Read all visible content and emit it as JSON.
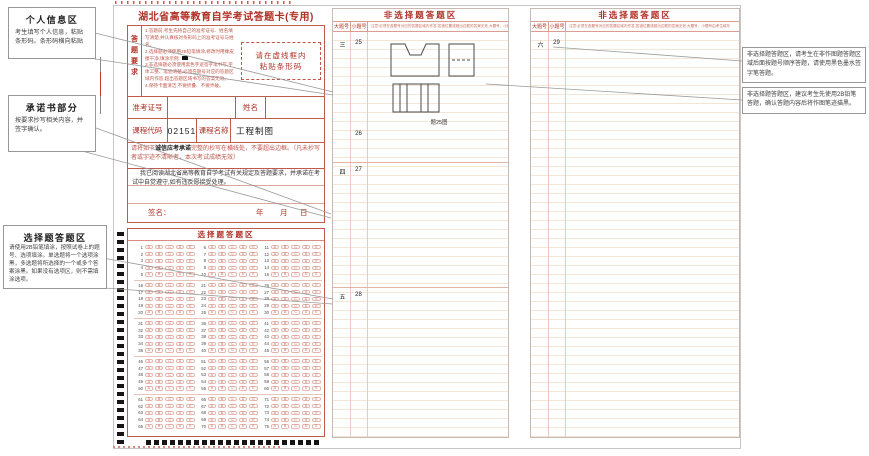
{
  "page_title": "湖北省高等教育自学考试答题卡(专用)",
  "colors": {
    "accent_red": "#b03026",
    "light_red": "#c0564a",
    "timing_mark_black": "#151515"
  },
  "left_callouts": [
    {
      "title": "个人信息区",
      "body": "考生填写个人信息，粘贴条形码。条形码横向粘贴"
    },
    {
      "title": "承诺书部分",
      "body": "按要求抄写相关内容，并签字确认。"
    },
    {
      "title": "选择题答题区",
      "body": "请使用2B铅笔填涂，按照试卷上的题号、选项填涂。单选题将一个选项涂黑，多选题将所选择的一个或多个答案涂黑。如果没有选项区，则不需填涂选项。"
    }
  ],
  "form": {
    "requirements_label": "答题要求",
    "requirements_lines": [
      "1.答题前,考生先将自己的准考证号、姓名填写清楚,并认真核对条形码上的准考证号与姓名。",
      "2.选择题必须使用2B铅笔填涂,修改时用橡皮擦干净,填涂示例:",
      "3.非选择题必须使用黑色字迹签字笔书写,字体工整、笔迹清楚,必须在题号对应的答题区域内作答,超出答题区域书写的答案无效。",
      "4.保持卡面清洁,不要折叠、不要弄破。"
    ],
    "example_square_line_index": 1,
    "barcode_line1": "请在虚线框内",
    "barcode_line2": "粘贴条形码",
    "admission_no_label": "准考证号",
    "name_label": "姓名",
    "course_code_label": "课程代码",
    "course_code_value": "02151",
    "course_name_label": "课程名称",
    "course_name_value": "工程制图",
    "pledge_notice_prefix": "请将如下",
    "pledge_notice_bold": "诚信应考承诺",
    "pledge_notice_suffix": "完整的抄写在横线处，不要超出边框。（凡未抄写者或字迹不清晰者，本次考试成绩无效）",
    "pledge_text": "我已阅读湖北省高等教育自学考试有关规定及答题要求，并承诺在考试中自觉遵守,如有违反愿接受处理。",
    "signature_label": "签名：",
    "date_labels": [
      "年",
      "月",
      "日"
    ]
  },
  "mc_section": {
    "title": "选择题答题区",
    "options": [
      "A",
      "B",
      "C",
      "D",
      "E"
    ],
    "rows_per_group": 5,
    "column_starts": [
      [
        1,
        6,
        11
      ],
      [
        16,
        21,
        26
      ],
      [
        31,
        36,
        41
      ],
      [
        46,
        51,
        56
      ],
      [
        61,
        66,
        71
      ]
    ]
  },
  "essay_panels": [
    {
      "title": "非选择题答题区",
      "col_major": "大题号",
      "col_minor": "小题号",
      "notice": "注意:必须在各题号对应的答题区域内作答,答错位置或超出边框的答案无效,大题号、小题号由考生填写",
      "rows": [
        {
          "major": "三",
          "minor": "25"
        },
        {
          "major": "",
          "minor": "26"
        },
        {
          "major": "四",
          "minor": "27"
        },
        {
          "major": "五",
          "minor": "28"
        }
      ],
      "figure_caption": "题25图"
    },
    {
      "title": "非选择题答题区",
      "col_major": "大题号",
      "col_minor": "小题号",
      "notice": "注意:必须在各题号对应的答题区域内作答,答错位置或超出边框的答案无效,大题号、小题号由考生填写",
      "rows": [
        {
          "major": "六",
          "minor": "29"
        }
      ]
    }
  ],
  "right_callouts": [
    {
      "body": "非选择题答题区，请考生在非作图题答题区域后面按题号顺序答题，请使用黑色墨水签字笔答题。"
    },
    {
      "body": "非选择题答题区，建议考生先使用2B铅笔答题，确认答题内容后将作图笔迹描黑。"
    }
  ]
}
